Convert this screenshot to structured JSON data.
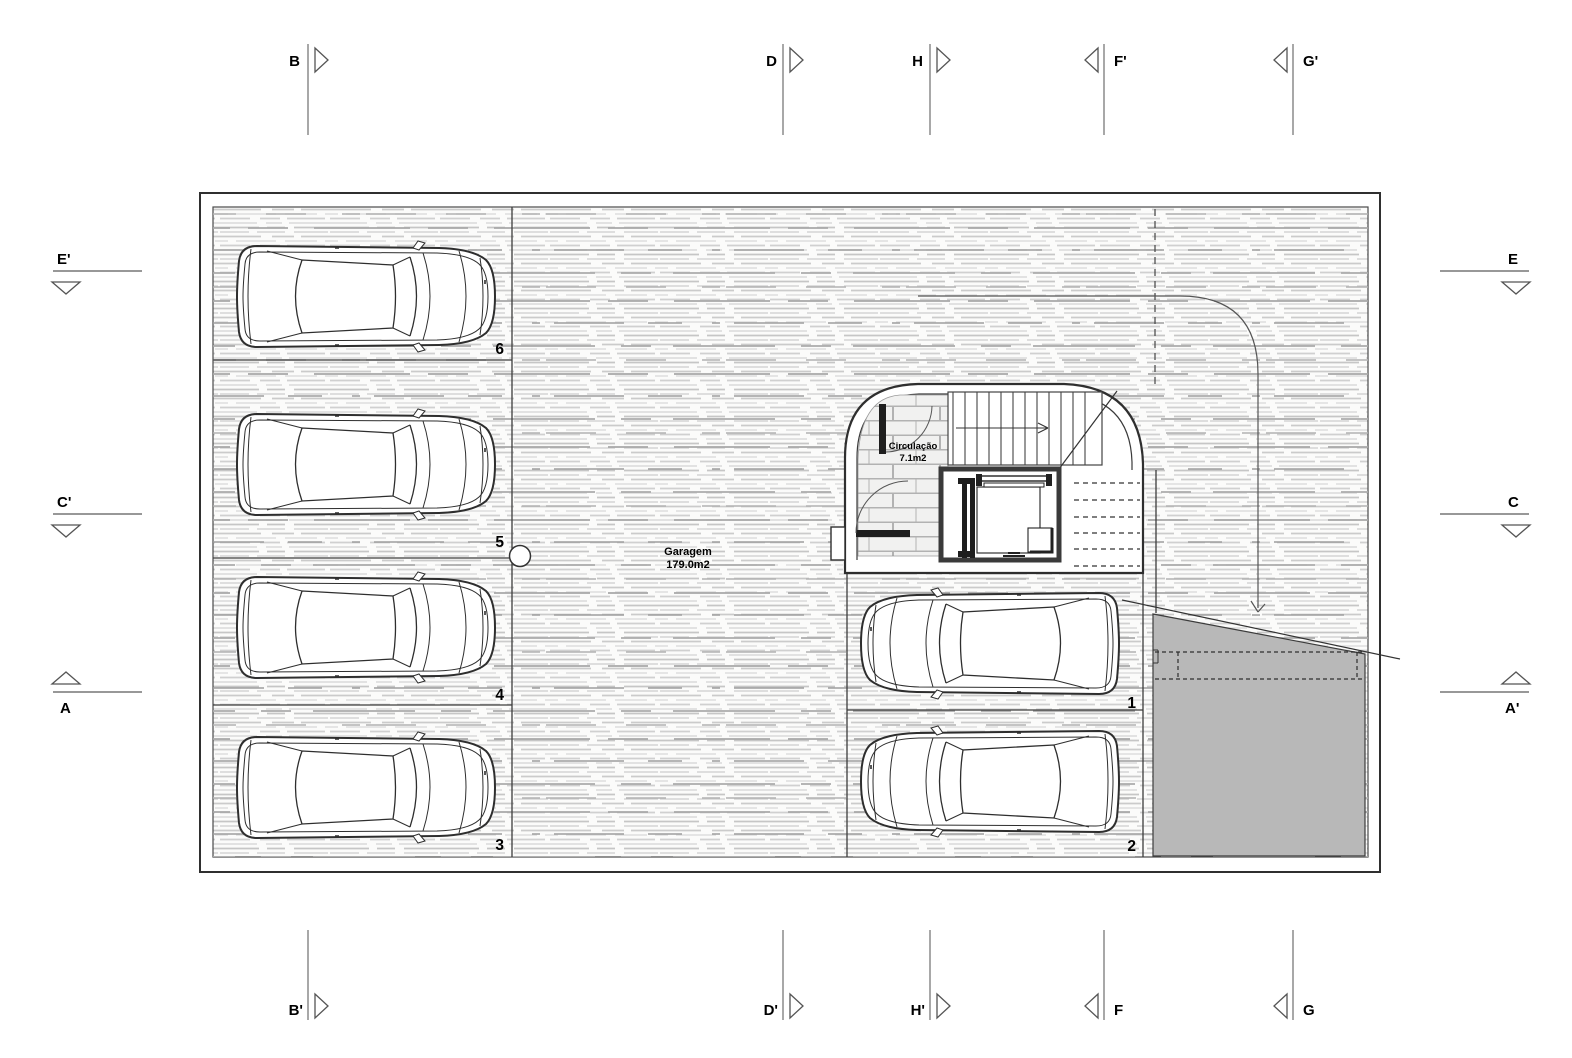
{
  "rooms": {
    "garage": {
      "name": "Garagem",
      "area": "179.0m2"
    },
    "circulation": {
      "name": "Circulação",
      "area": "7.1m2"
    }
  },
  "parking": {
    "p1": "1",
    "p2": "2",
    "p3": "3",
    "p4": "4",
    "p5": "5",
    "p6": "6"
  },
  "markers": {
    "top": {
      "b": "B",
      "d": "D",
      "h": "H",
      "fp": "F'",
      "gp": "G'"
    },
    "bottom": {
      "bp": "B'",
      "dp": "D'",
      "hp": "H'",
      "f": "F",
      "g": "G"
    },
    "left": {
      "ep": "E'",
      "cp": "C'",
      "a": "A"
    },
    "right": {
      "e": "E",
      "c": "C",
      "ap": "A'"
    }
  },
  "colors": {
    "line": "#3a3a3a",
    "marker_line": "#8a8a8a",
    "ramp_fill": "#b8b8b8",
    "hatch_line": "#cfcfcf"
  }
}
